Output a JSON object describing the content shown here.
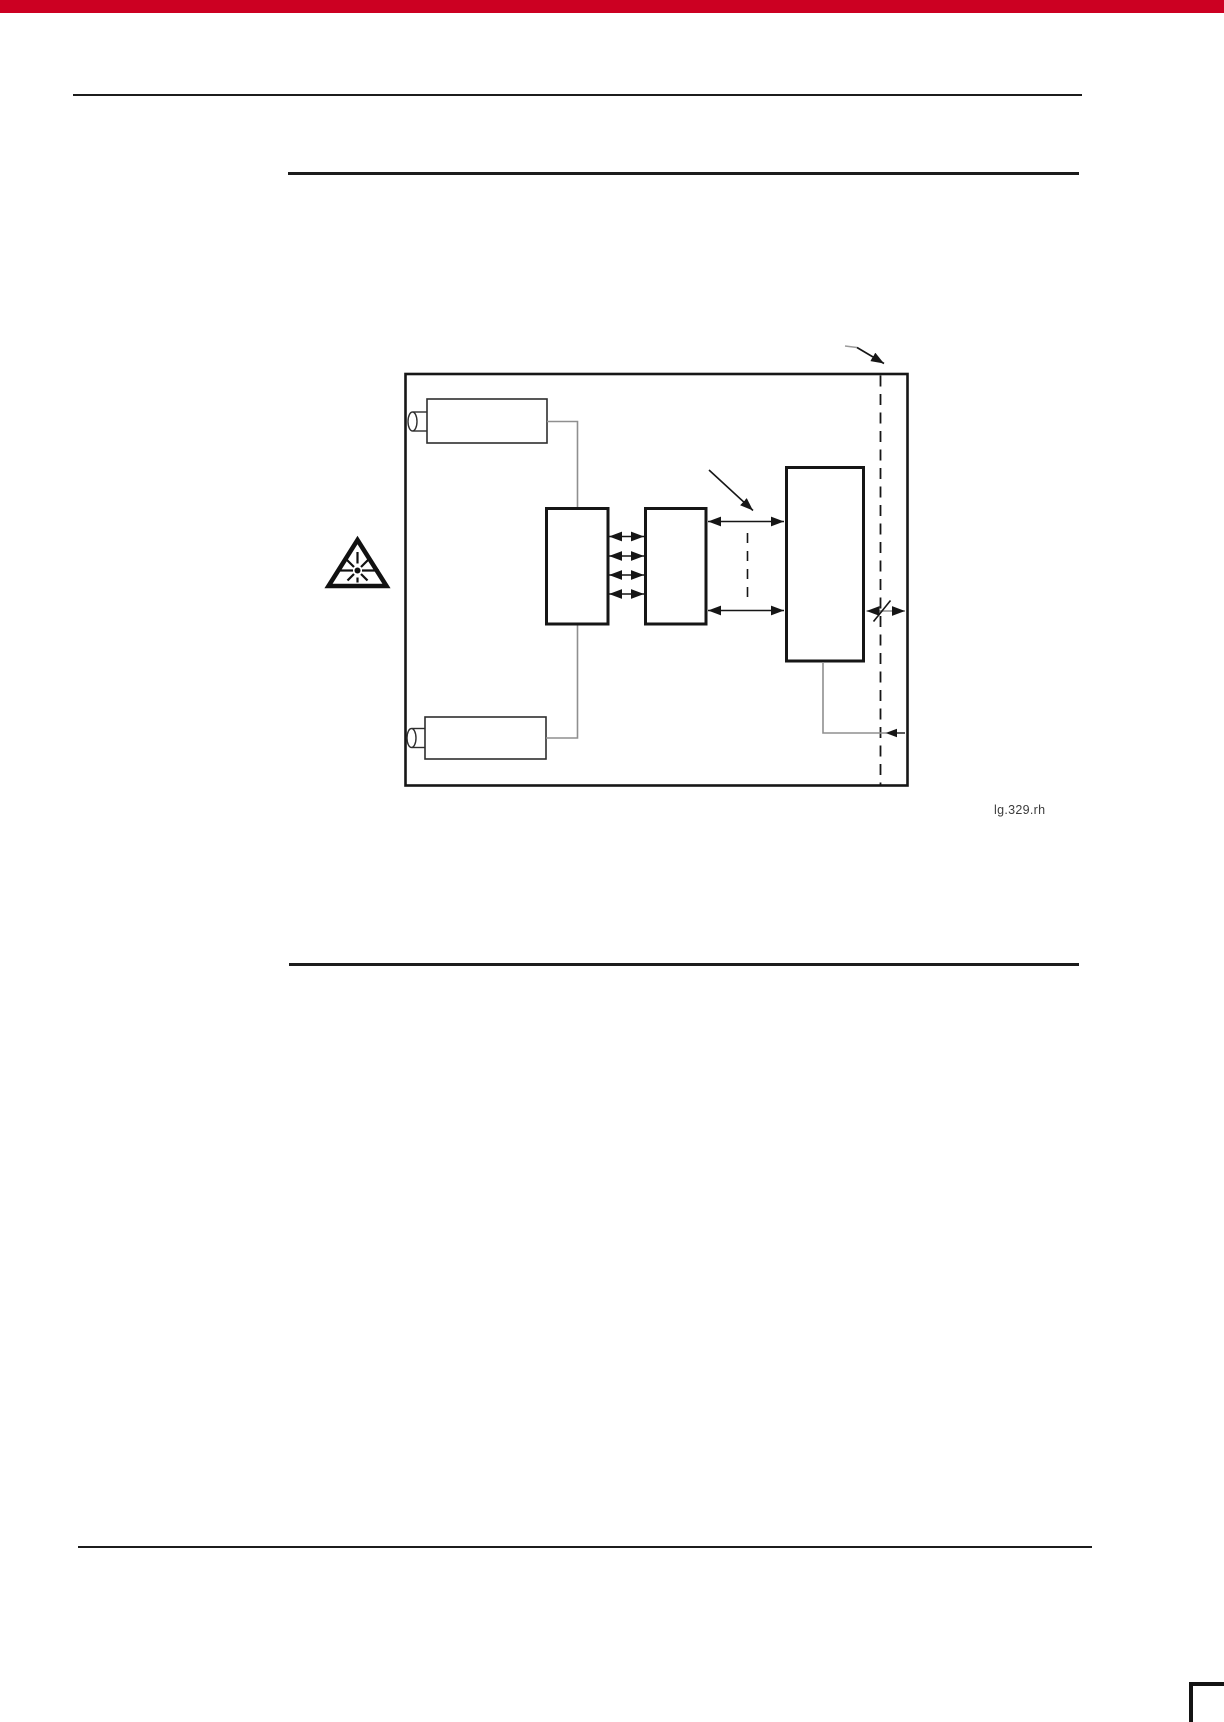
{
  "page": {
    "background": "#ffffff",
    "accent_bar_color": "#cc0022",
    "rule_color": "#1c1c1c"
  },
  "figure": {
    "caption": "lg.329.rh",
    "stroke_color": "#161616",
    "connector_color": "#8f8f8f",
    "warning_icon": "laser-radiation-warning-icon"
  }
}
